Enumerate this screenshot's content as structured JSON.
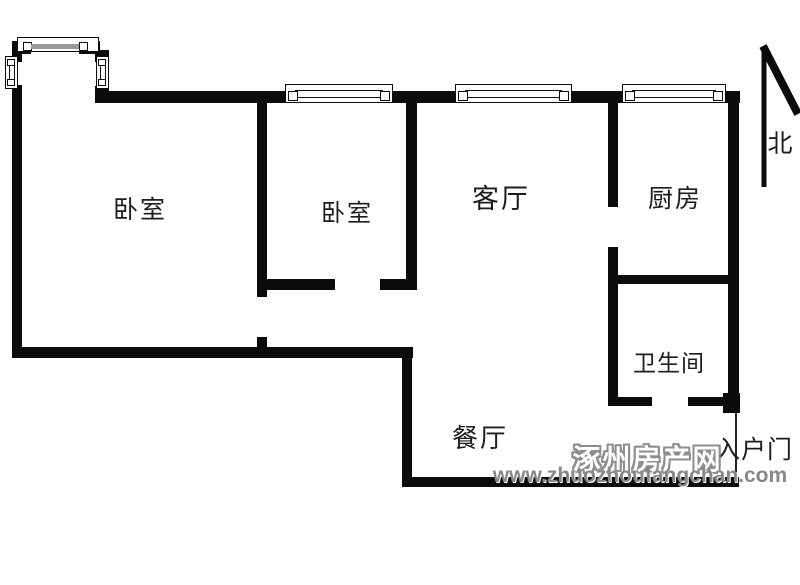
{
  "floorplan": {
    "rooms": [
      {
        "id": "bedroom-1",
        "label": "卧室"
      },
      {
        "id": "bedroom-2",
        "label": "卧室"
      },
      {
        "id": "living-room",
        "label": "客厅"
      },
      {
        "id": "kitchen",
        "label": "厨房"
      },
      {
        "id": "bathroom",
        "label": "卫生间"
      },
      {
        "id": "dining-room",
        "label": "餐厅"
      }
    ],
    "annotations": {
      "north_label": "北",
      "entry_door_label": "入户门"
    },
    "watermark": {
      "site_name": "涿州房产网",
      "site_url": "www.zhuozhoufangchan.com",
      "color": "#8d8d8d"
    },
    "colors": {
      "wall": "#0b0b0b",
      "background": "#ffffff",
      "window_glaze": "#9a9a9a"
    }
  }
}
